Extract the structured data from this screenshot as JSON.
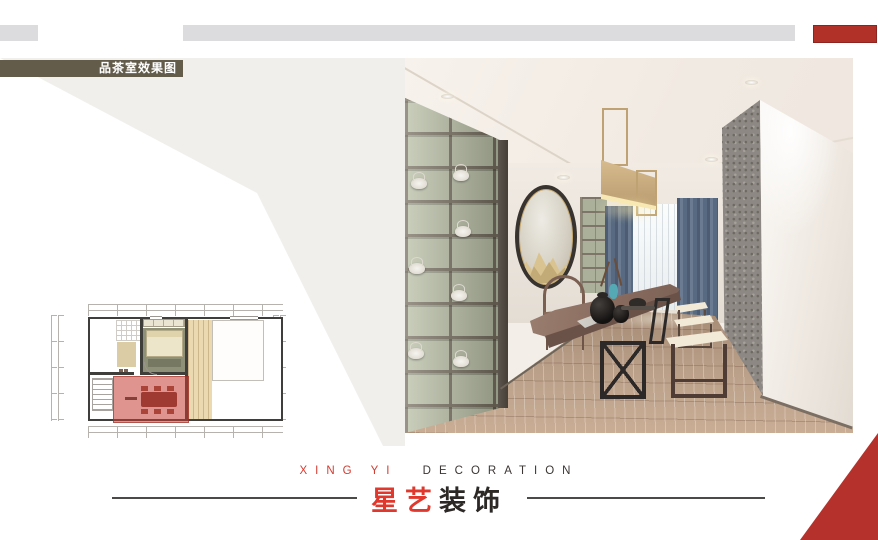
{
  "header": {
    "section_label": "品茶室效果图"
  },
  "footer": {
    "brand_en_primary": "XING YI",
    "brand_en_secondary": "DECORATION",
    "brand_cn_primary": "星艺",
    "brand_cn_secondary": "装饰"
  },
  "colors": {
    "accent_red": "#b5312b",
    "brand_red": "#d43b30",
    "label_olive": "#645c4b",
    "bar_gray": "#dcdcde",
    "panel_gray": "#f1efec",
    "plan_highlight_red": "rgba(197,61,51,0.55)"
  }
}
